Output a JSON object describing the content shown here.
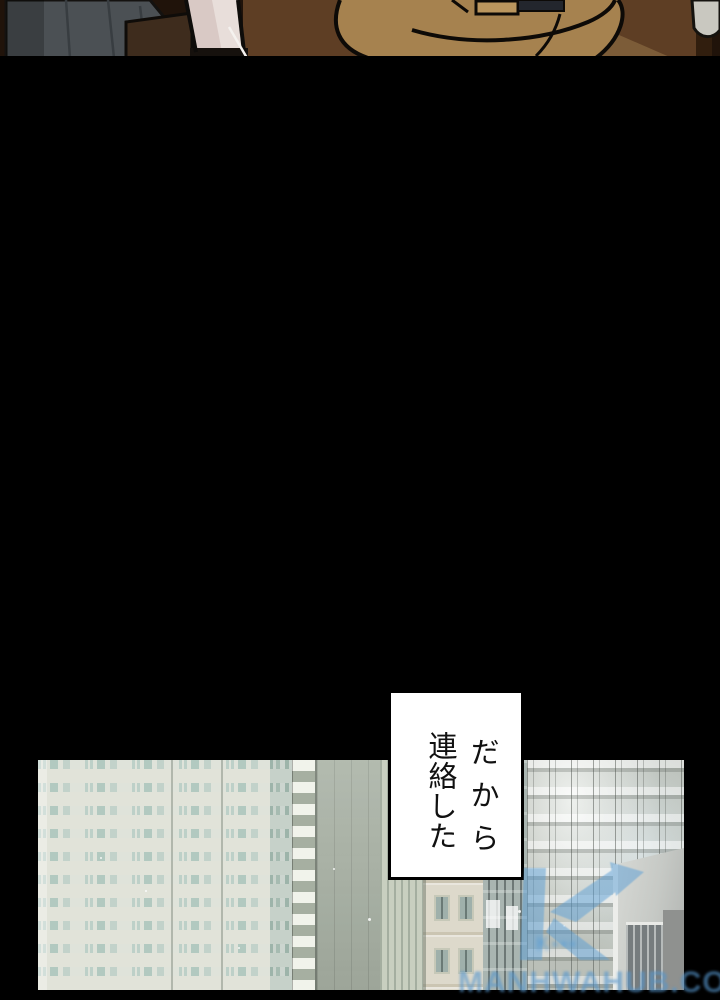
{
  "comic": {
    "speech_bubble": {
      "full_text": "だから連絡した",
      "columns": [
        "だから",
        "連絡した"
      ]
    },
    "watermark": {
      "logo_icon": "k-arrow-logo",
      "subtext": "K▪▪▪",
      "url_text": "MANHWAHUB.COM",
      "color": "#5b9fd6"
    }
  }
}
